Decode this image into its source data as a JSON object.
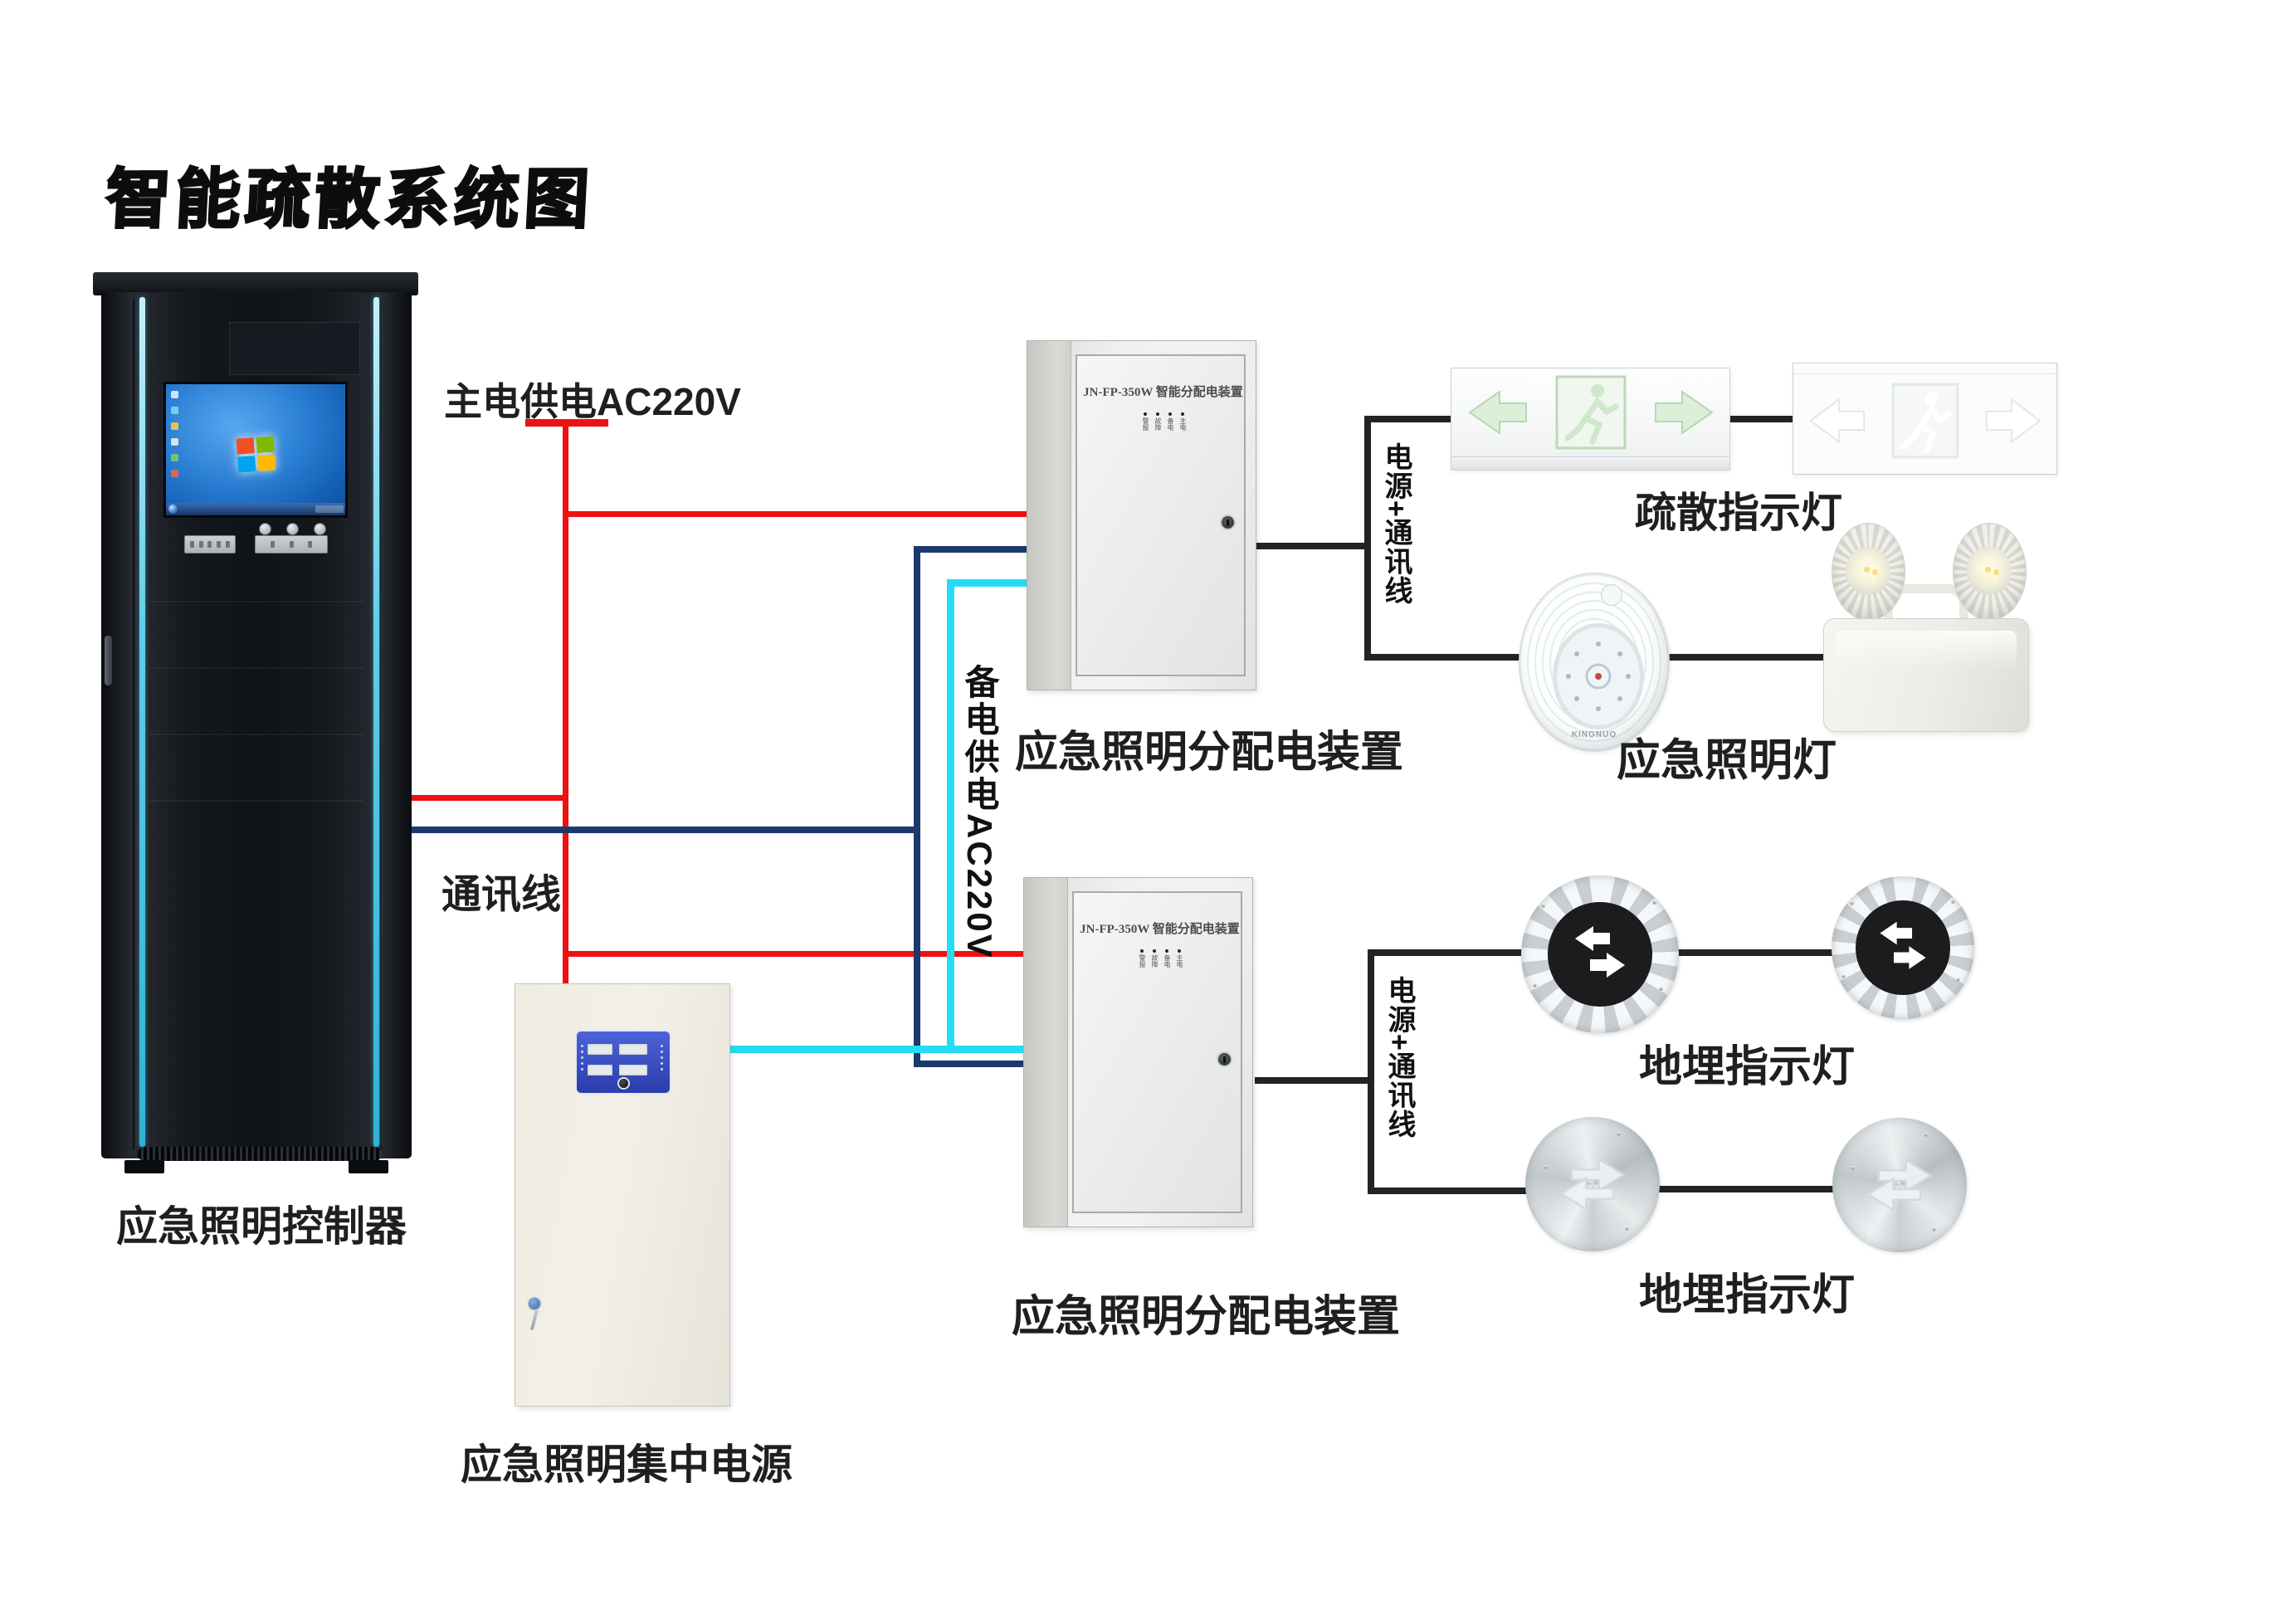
{
  "title": "智能疏散系统图",
  "colors": {
    "main_power_line": "#ee1111",
    "comm_line": "#1a3a6c",
    "backup_power_line": "#25dcf5",
    "signal_line": "#232323"
  },
  "cabinet": {
    "label": "应急照明控制器"
  },
  "wire_labels": {
    "main_power": "主电供电AC220V",
    "comm": "通讯线",
    "backup_power": "备电供电AC220V",
    "power_comm": "电源+通讯线"
  },
  "distribution_box": {
    "model": "JN-FP-350W 智能分配电装置",
    "label": "应急照明分配电装置",
    "led_labels": [
      "警报",
      "故障",
      "备电",
      "主电"
    ]
  },
  "power_supply": {
    "label": "应急照明集中电源"
  },
  "devices": {
    "exit_sign_label": "疏散指示灯",
    "emergency_light_label": "应急照明灯",
    "ground_light_label": "地埋指示灯",
    "lamp_brand": "KINGNUO"
  }
}
